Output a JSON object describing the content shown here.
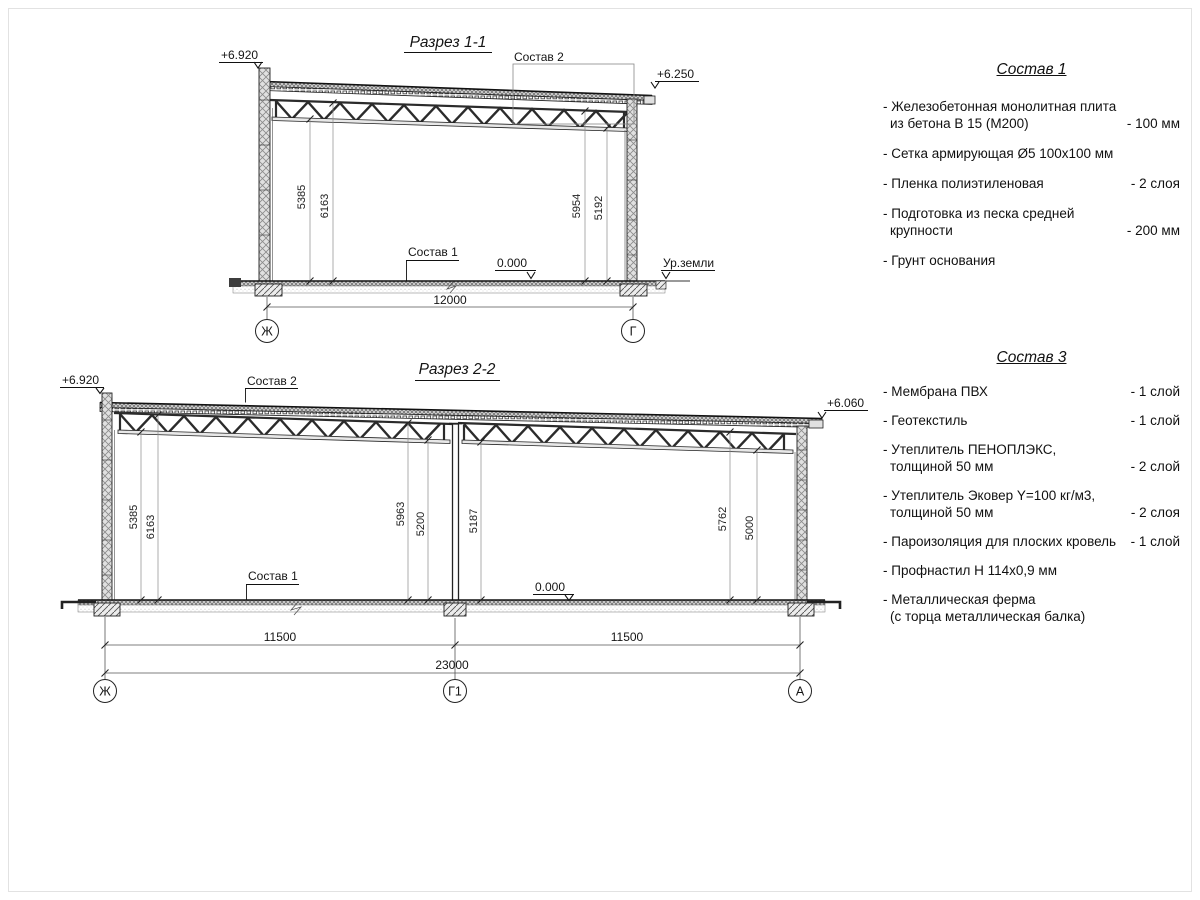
{
  "page": {
    "background": "#ffffff",
    "line_color": "#1f1f1f"
  },
  "section1": {
    "title": "Разрез 1-1",
    "elev_left": "+6.920",
    "elev_right": "+6.250",
    "callout_roof": "Состав 2",
    "callout_floor": "Состав 1",
    "level_zero": "0.000",
    "ground_level": "Ур.земли",
    "dim_left_outer": "5385",
    "dim_left_inner": "6163",
    "dim_right_inner": "5954",
    "dim_right_outer": "5192",
    "dim_span": "12000",
    "axis_left": "Ж",
    "axis_right": "Г"
  },
  "section2": {
    "title": "Разрез 2-2",
    "elev_left": "+6.920",
    "elev_right": "+6.060",
    "callout_roof": "Состав 2",
    "callout_floor": "Состав 1",
    "level_zero": "0.000",
    "dim_1": "5385",
    "dim_2": "6163",
    "dim_3": "5963",
    "dim_4": "5200",
    "dim_5": "5187",
    "dim_6": "5762",
    "dim_7": "5000",
    "dim_bay1": "11500",
    "dim_bay2": "11500",
    "dim_total": "23000",
    "axis_left": "Ж",
    "axis_mid": "Г1",
    "axis_right": "А"
  },
  "sostav1": {
    "title": "Состав 1",
    "items": [
      {
        "line1": "- Железобетонная монолитная плита",
        "line2": "из бетона В 15 (М200)",
        "value": "- 100 мм"
      },
      {
        "line1": "- Сетка армирующая Ø5 100х100 мм"
      },
      {
        "line1": "- Пленка полиэтиленовая",
        "value": "-  2 слоя"
      },
      {
        "line1": "- Подготовка из песка средней",
        "line2": "крупности",
        "value": "- 200 мм"
      },
      {
        "line1": "- Грунт основания"
      }
    ]
  },
  "sostav3": {
    "title": "Состав 3",
    "items": [
      {
        "line1": "- Мембрана ПВХ",
        "value": "- 1 слой"
      },
      {
        "line1": "- Геотекстиль",
        "value": "- 1 слой"
      },
      {
        "line1": "- Утеплитель ПЕНОПЛЭКС,",
        "line2": "толщиной 50 мм",
        "value": "- 2 слой"
      },
      {
        "line1": "- Утеплитель Эковер Y=100 кг/м3,",
        "line2": "толщиной 50 мм",
        "value": "- 2 слоя"
      },
      {
        "line1": "- Пароизоляция для плоских кровель",
        "value": "- 1 слой"
      },
      {
        "line1": "- Профнастил Н 114х0,9 мм"
      },
      {
        "line1": "- Металлическая ферма",
        "line2": "(с торца металлическая балка)"
      }
    ]
  }
}
